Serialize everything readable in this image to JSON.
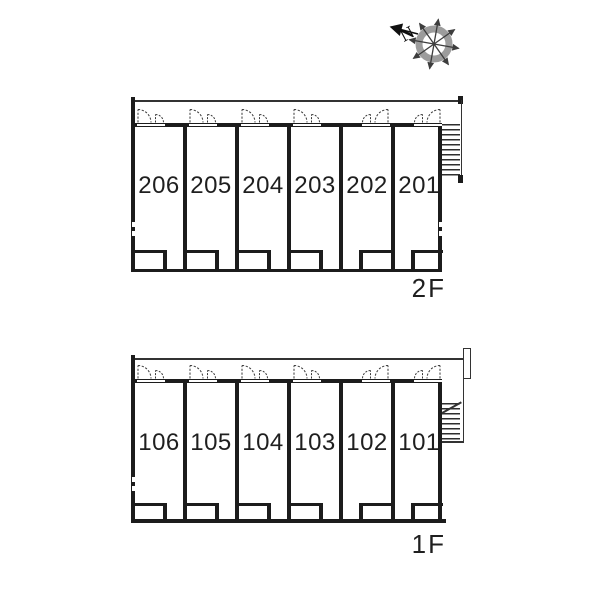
{
  "compass": {
    "north_label": "N"
  },
  "colors": {
    "wall": "#1c1c1c",
    "thin_line": "#333333",
    "compass_ring": "#9c9c9c",
    "compass_spokes": "#3d3d3d",
    "text": "#1f1f1f",
    "background": "#ffffff"
  },
  "floors": [
    {
      "label": "2F",
      "units": [
        {
          "number": "206",
          "door": "left",
          "notch": "right"
        },
        {
          "number": "205",
          "door": "left",
          "notch": "right"
        },
        {
          "number": "204",
          "door": "left",
          "notch": "right"
        },
        {
          "number": "203",
          "door": "left",
          "notch": "right"
        },
        {
          "number": "202",
          "door": "right",
          "notch": "left"
        },
        {
          "number": "201",
          "door": "right",
          "notch": "left"
        }
      ]
    },
    {
      "label": "1F",
      "units": [
        {
          "number": "106",
          "door": "left",
          "notch": "right"
        },
        {
          "number": "105",
          "door": "left",
          "notch": "right"
        },
        {
          "number": "104",
          "door": "left",
          "notch": "right"
        },
        {
          "number": "103",
          "door": "left",
          "notch": "right"
        },
        {
          "number": "102",
          "door": "right",
          "notch": "left"
        },
        {
          "number": "101",
          "door": "right",
          "notch": "left"
        }
      ]
    }
  ]
}
